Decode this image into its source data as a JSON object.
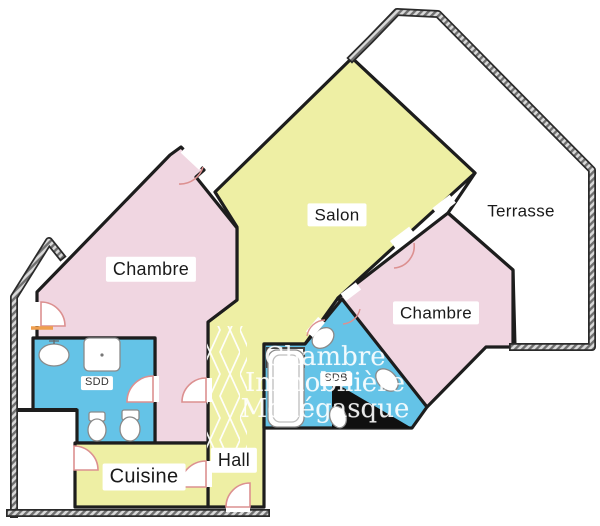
{
  "plan": {
    "rooms": {
      "chambre_left": {
        "label": "Chambre"
      },
      "salon": {
        "label": "Salon"
      },
      "terrasse": {
        "label": "Terrasse"
      },
      "chambre_right": {
        "label": "Chambre"
      },
      "sdd": {
        "label": "SDD"
      },
      "sdb": {
        "label": "SDB"
      },
      "cuisine": {
        "label": "Cuisine"
      },
      "hall": {
        "label": "Hall"
      }
    },
    "watermark": {
      "line1": "Chambre",
      "line2": "Immobilière",
      "line3": "Monégasque"
    },
    "colors": {
      "room_pink": "#f0d6e1",
      "room_yellow": "#eeefa4",
      "room_blue": "#64c3e7",
      "terrace_white": "#ffffff",
      "wall": "#1d1d1d",
      "door_arc": "#dc9090",
      "threshold_orange": "#ef9f4e"
    }
  }
}
